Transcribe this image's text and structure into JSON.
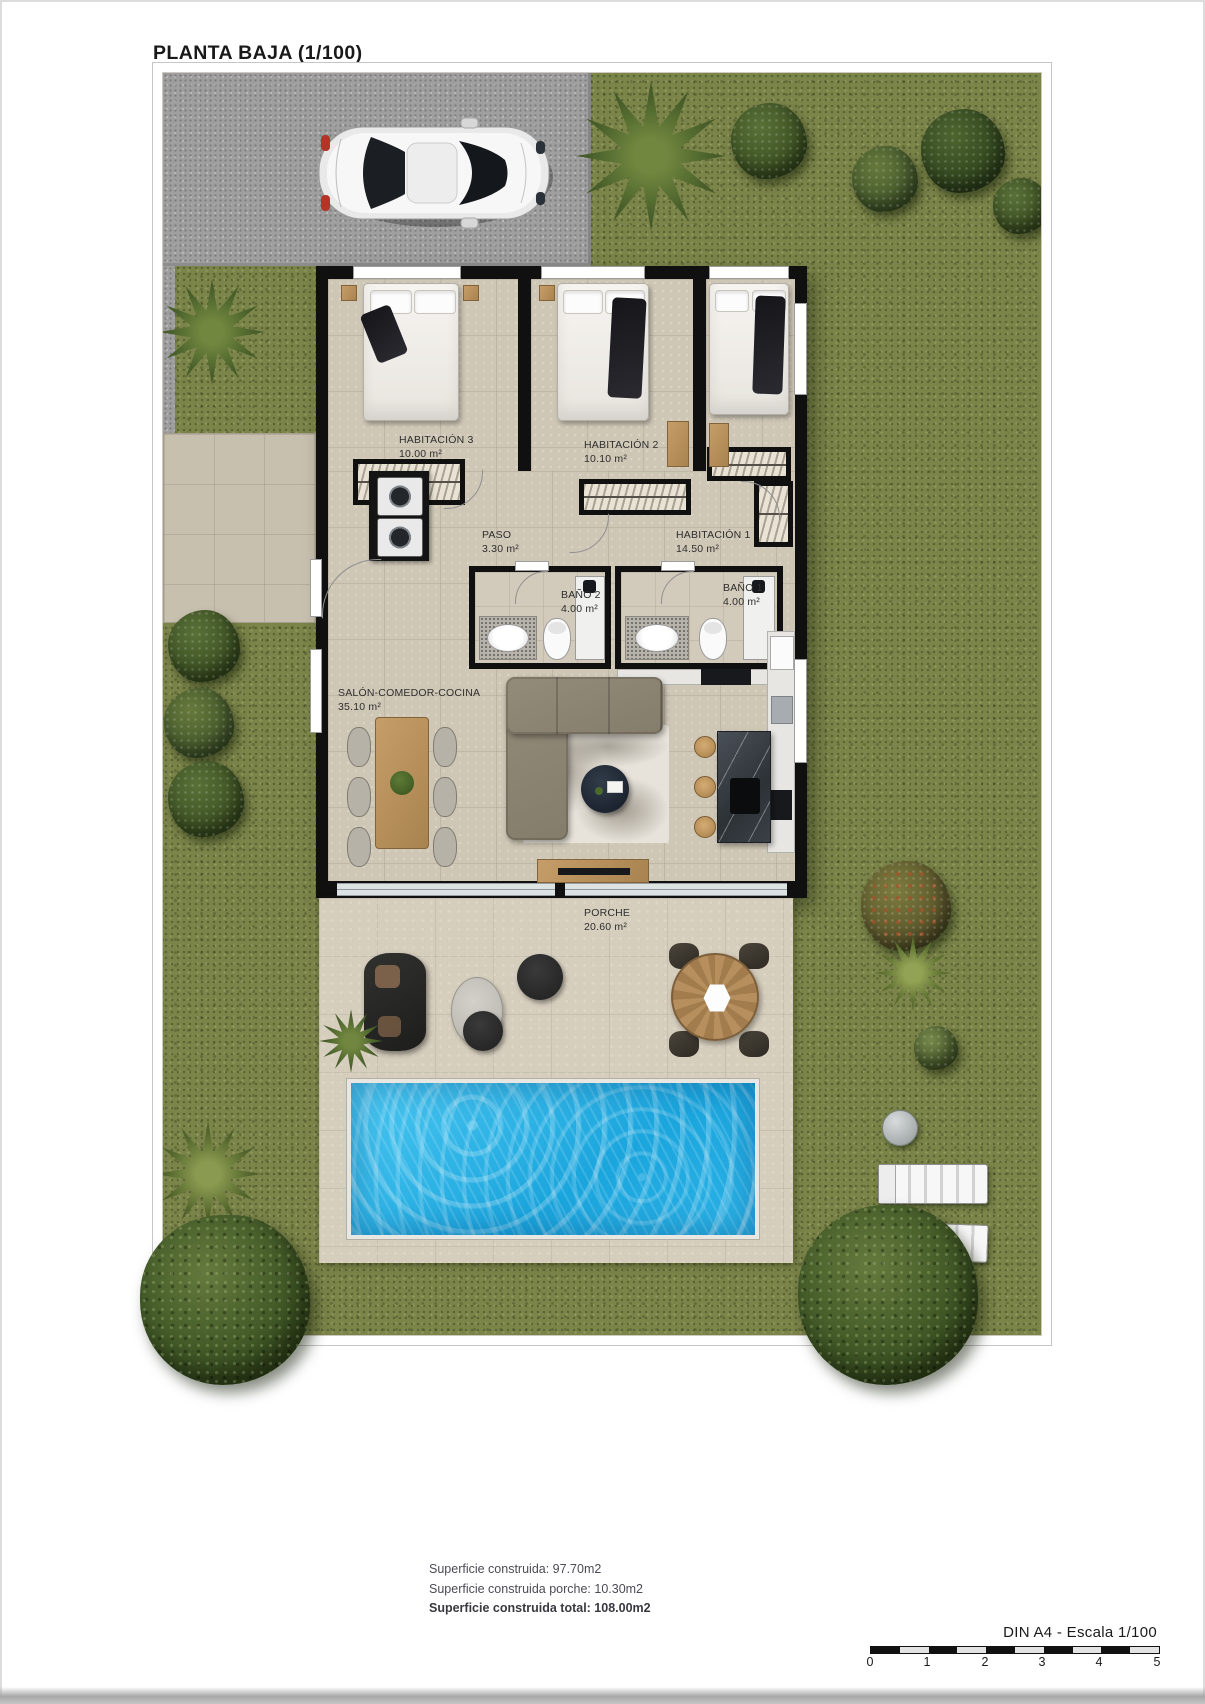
{
  "title": "PLANTA BAJA (1/100)",
  "rooms": {
    "habitacion3": {
      "name": "HABITACIÓN 3",
      "area": "10.00 m²"
    },
    "habitacion2": {
      "name": "HABITACIÓN 2",
      "area": "10.10 m²"
    },
    "habitacion1": {
      "name": "HABITACIÓN 1",
      "area": "14.50 m²"
    },
    "paso": {
      "name": "PASO",
      "area": "3.30 m²"
    },
    "bano2": {
      "name": "BAÑO 2",
      "area": "4.00 m²"
    },
    "bano1": {
      "name": "BAÑO 1",
      "area": "4.00 m²"
    },
    "salon": {
      "name": "SALÓN-COMEDOR-COCINA",
      "area": "35.10 m²"
    },
    "porche": {
      "name": "PORCHE",
      "area": "20.60 m²"
    }
  },
  "summary": {
    "line1": "Superficie construida: 97.70m2",
    "line2": "Superficie construida porche: 10.30m2",
    "line3": "Superficie construida total: 108.00m2"
  },
  "scalebar": {
    "label": "DIN A4 - Escala 1/100",
    "ticks": [
      "0",
      "1",
      "2",
      "3",
      "4",
      "5"
    ]
  },
  "colors": {
    "pool_water": "#29b6e8",
    "grass": "#7b8449",
    "floor_tile": "#cfc7b6",
    "wall": "#101010"
  }
}
